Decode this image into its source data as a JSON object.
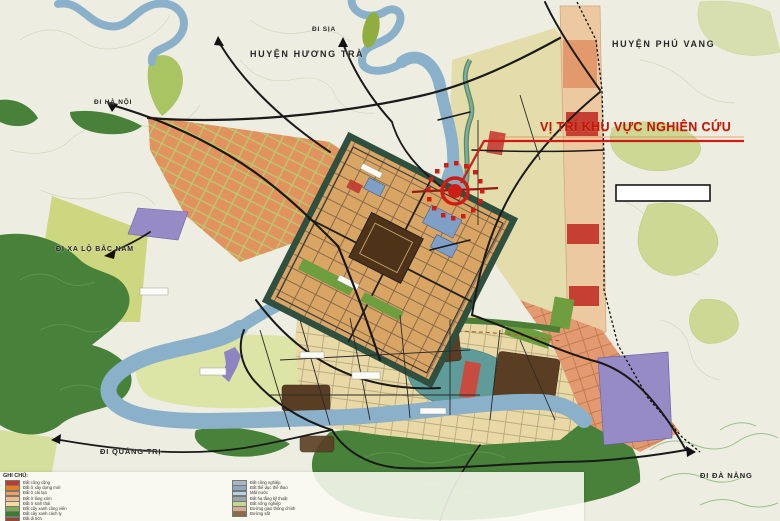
{
  "map_title_note": "Quy hoạch đô thị Huế (sơ đồ vị trí)",
  "labels": {
    "di_sia": "ĐI SỊA",
    "huyen_huong_tra": "HUYỆN HƯƠNG TRÀ",
    "di_ha_noi": "ĐI HÀ NỘI",
    "huyen_phu_vang": "HUYỆN PHÚ VANG",
    "study_area_title": "VỊ TRÍ KHU VỰC NGHIÊN CỨU",
    "di_xa_lo_bac_nam": "ĐI XA LỘ BẮC NAM",
    "di_quang_tri": "ĐI QUẢNG TRỊ",
    "di_da_nang": "ĐI ĐÀ NẴNG"
  },
  "legend": {
    "title": "GHI CHÚ:",
    "col1": [
      {
        "label": "Đất công cộng",
        "color": "#c0392b"
      },
      {
        "label": "Đất ở xây dựng mới",
        "color": "#e67e22"
      },
      {
        "label": "Đất ở cải tạo",
        "color": "#ef9f60"
      },
      {
        "label": "Đất ở làng xóm",
        "color": "#f2b98c"
      },
      {
        "label": "Đất ở sinh thái",
        "color": "#f7dba8"
      },
      {
        "label": "Đất cây xanh công viên",
        "color": "#7dab4e"
      },
      {
        "label": "Đất cây xanh cách ly",
        "color": "#3f7a33"
      },
      {
        "label": "Đất di tích",
        "color": "#8e4c33"
      }
    ],
    "col2": [
      {
        "label": "Đất công nghiệp",
        "color": "#a9b6bf"
      },
      {
        "label": "Đất thể dục thể thao",
        "color": "#8fa8bd"
      },
      {
        "label": "Mặt nước",
        "color": "#b7d3e3"
      },
      {
        "label": "Đất hạ tầng kỹ thuật",
        "color": "#9aa5a8"
      },
      {
        "label": "Đất nông nghiệp",
        "color": "#c5d68e"
      },
      {
        "label": "Đường giao thông chính",
        "color": "#d8ab91"
      },
      {
        "label": "Đường sắt",
        "color": "#8c6b4a"
      }
    ]
  },
  "colors": {
    "accent_red": "#cf1d15",
    "river_blue": "#8ab1c9",
    "forest_green": "#47813a",
    "orange_district": "#e2925f",
    "citadel_tan": "#d8a565",
    "lake_teal": "#5f9b98",
    "purple_area": "#968bc5",
    "lime_agriculture": "#ccd77f",
    "cream_district": "#e9d9a6",
    "khaki_band": "#e3dcab",
    "road_black": "#1a1a1a",
    "paper": "#edeee1"
  },
  "callout_box": {
    "text": ""
  }
}
